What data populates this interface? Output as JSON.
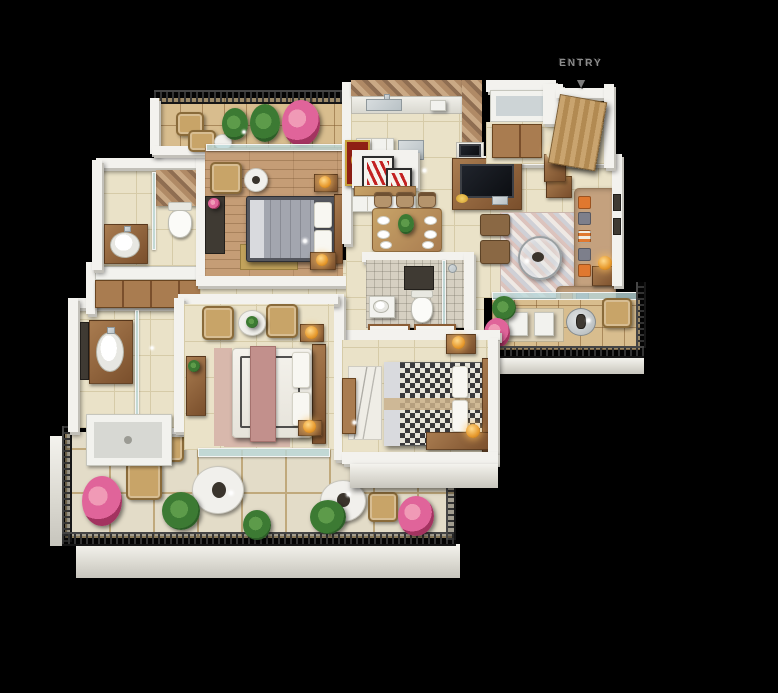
{
  "entry": {
    "label": "ENTRY",
    "arrow": "▼"
  },
  "scene": {
    "type": "3d-isometric-floor-plan-render",
    "rooms": [
      "entry-foyer",
      "kitchen",
      "pooja-corner",
      "dining",
      "living-room",
      "living-balcony",
      "bedroom-1",
      "bedroom-1-balcony",
      "common-bathroom",
      "wardrobe-passage",
      "master-bathroom",
      "master-bedroom",
      "bathroom-2",
      "bedroom-2",
      "terrace"
    ]
  },
  "colors": {
    "background": "#000000",
    "wall": "#f3f2ee",
    "wall-shade": "#c2c0b9",
    "floor-cream": "#eae2c8",
    "floor-line": "#d6cba8",
    "floor-wood": "#c59d76",
    "balc-floor": "#d8bd8e",
    "terrace-floor": "#e3dcc8",
    "terrace-line": "#c0a97c",
    "railing-dark": "#333333",
    "glass-tint": "#b9d7d8",
    "sofa": "#c4a17e",
    "cushion-orange": "#e0782f",
    "cushion-gray": "#7d7f8b",
    "wood-dark": "#7a4f2c",
    "wood-mid": "#a97c50",
    "wood-light": "#c8a468",
    "bed-white": "#f2f0ea",
    "bed-gray": "#55575e",
    "runner-pink": "#c2908c",
    "rug-pink": "#d8b8ac",
    "rug-gold": "#c2a35c",
    "rug-gray": "#cfd0d6",
    "pattern-dark": "#3a3a3d",
    "plant-green": "#3c7a33",
    "plant-dark": "#2c5e27",
    "flower-pink": "#e0649a",
    "lamp-gold": "#e79a2e",
    "lamp-cream": "#ead9ae",
    "art-red": "#c32222",
    "pooja-red": "#8f1f14",
    "pooja-gold": "#c9a23c",
    "mosaic-a": "#b08a66",
    "mosaic-b": "#8f6e52",
    "mosaic-c": "#caa985",
    "steel": "#b9c2c6",
    "tv-dark": "#14161c",
    "entry-text": "#8d8d8d"
  }
}
